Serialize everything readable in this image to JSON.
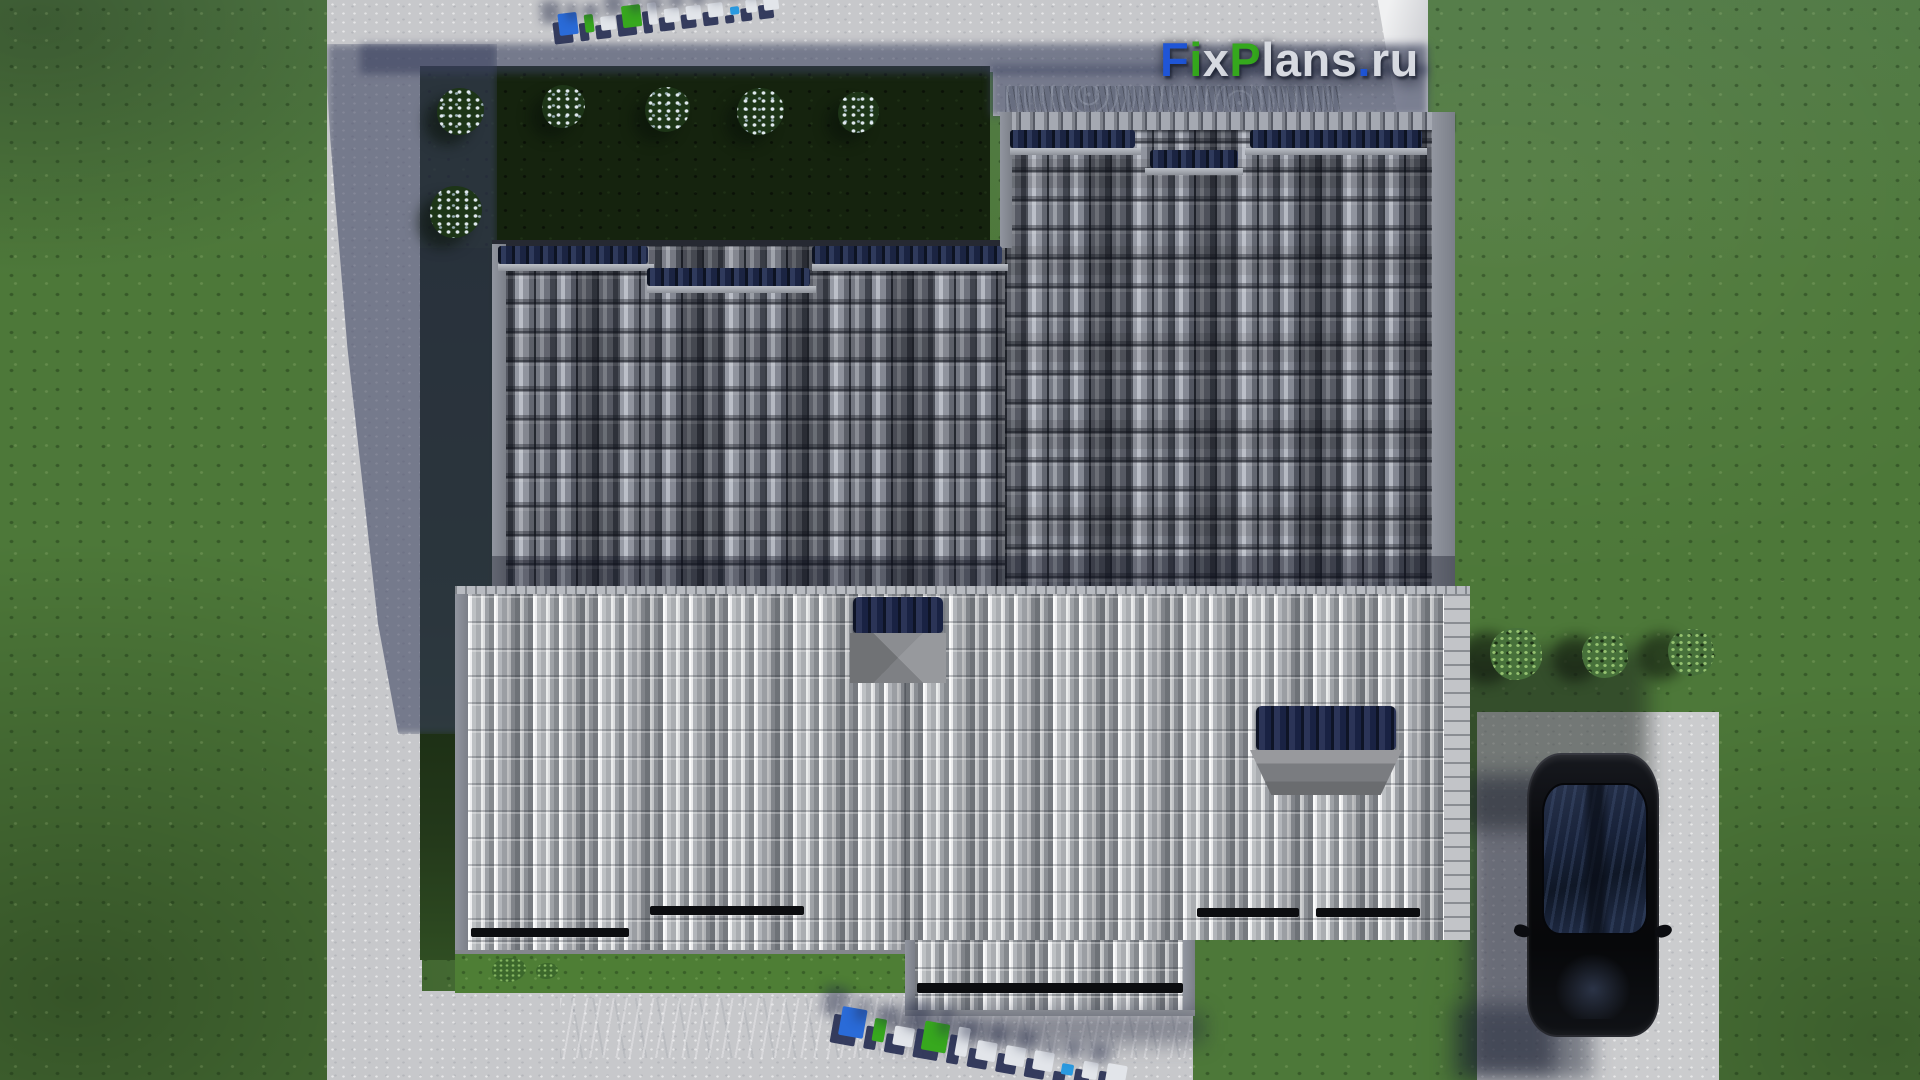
{
  "watermark": {
    "text": "FixPlans.ru",
    "segments": [
      {
        "text": "F",
        "color": "#1f55d6"
      },
      {
        "text": "i",
        "color": "#35a81d"
      },
      {
        "text": "x",
        "color": "#d7dae1"
      },
      {
        "text": "P",
        "color": "#35a81d"
      },
      {
        "text": "lans",
        "color": "#d7dae1"
      },
      {
        "text": ".",
        "color": "#1f55d6"
      },
      {
        "text": "ru",
        "color": "#d7dae1"
      }
    ]
  },
  "ground_logo": {
    "text": "FixPlans.ru",
    "letter_colors": [
      "#2a6bd8",
      "#37a81e",
      "#e2e5ea",
      "#37a81e",
      "#e2e5ea",
      "#e2e5ea",
      "#e2e5ea",
      "#e2e5ea",
      "#2a9ae0",
      "#e2e5ea",
      "#e2e5ea"
    ]
  },
  "palette": {
    "lawn_green": "#4d7839",
    "garden_bed_green": "#15230e",
    "concrete_gray": "#c7c8cb",
    "shadow_blue": "#3a4262",
    "roof_dark_tile": "#6a6e79",
    "roof_light_tile": "#ced0d3",
    "skylight_navy": "#1c2440",
    "hatch_cap_gray": "#87898d",
    "gutter_black": "#0c0d10",
    "driveway_gray": "#cbccce",
    "car_black": "#0a0b0e",
    "logo_blue": "#1f55d6",
    "logo_green": "#35a81d",
    "logo_white": "#d7dae1"
  }
}
